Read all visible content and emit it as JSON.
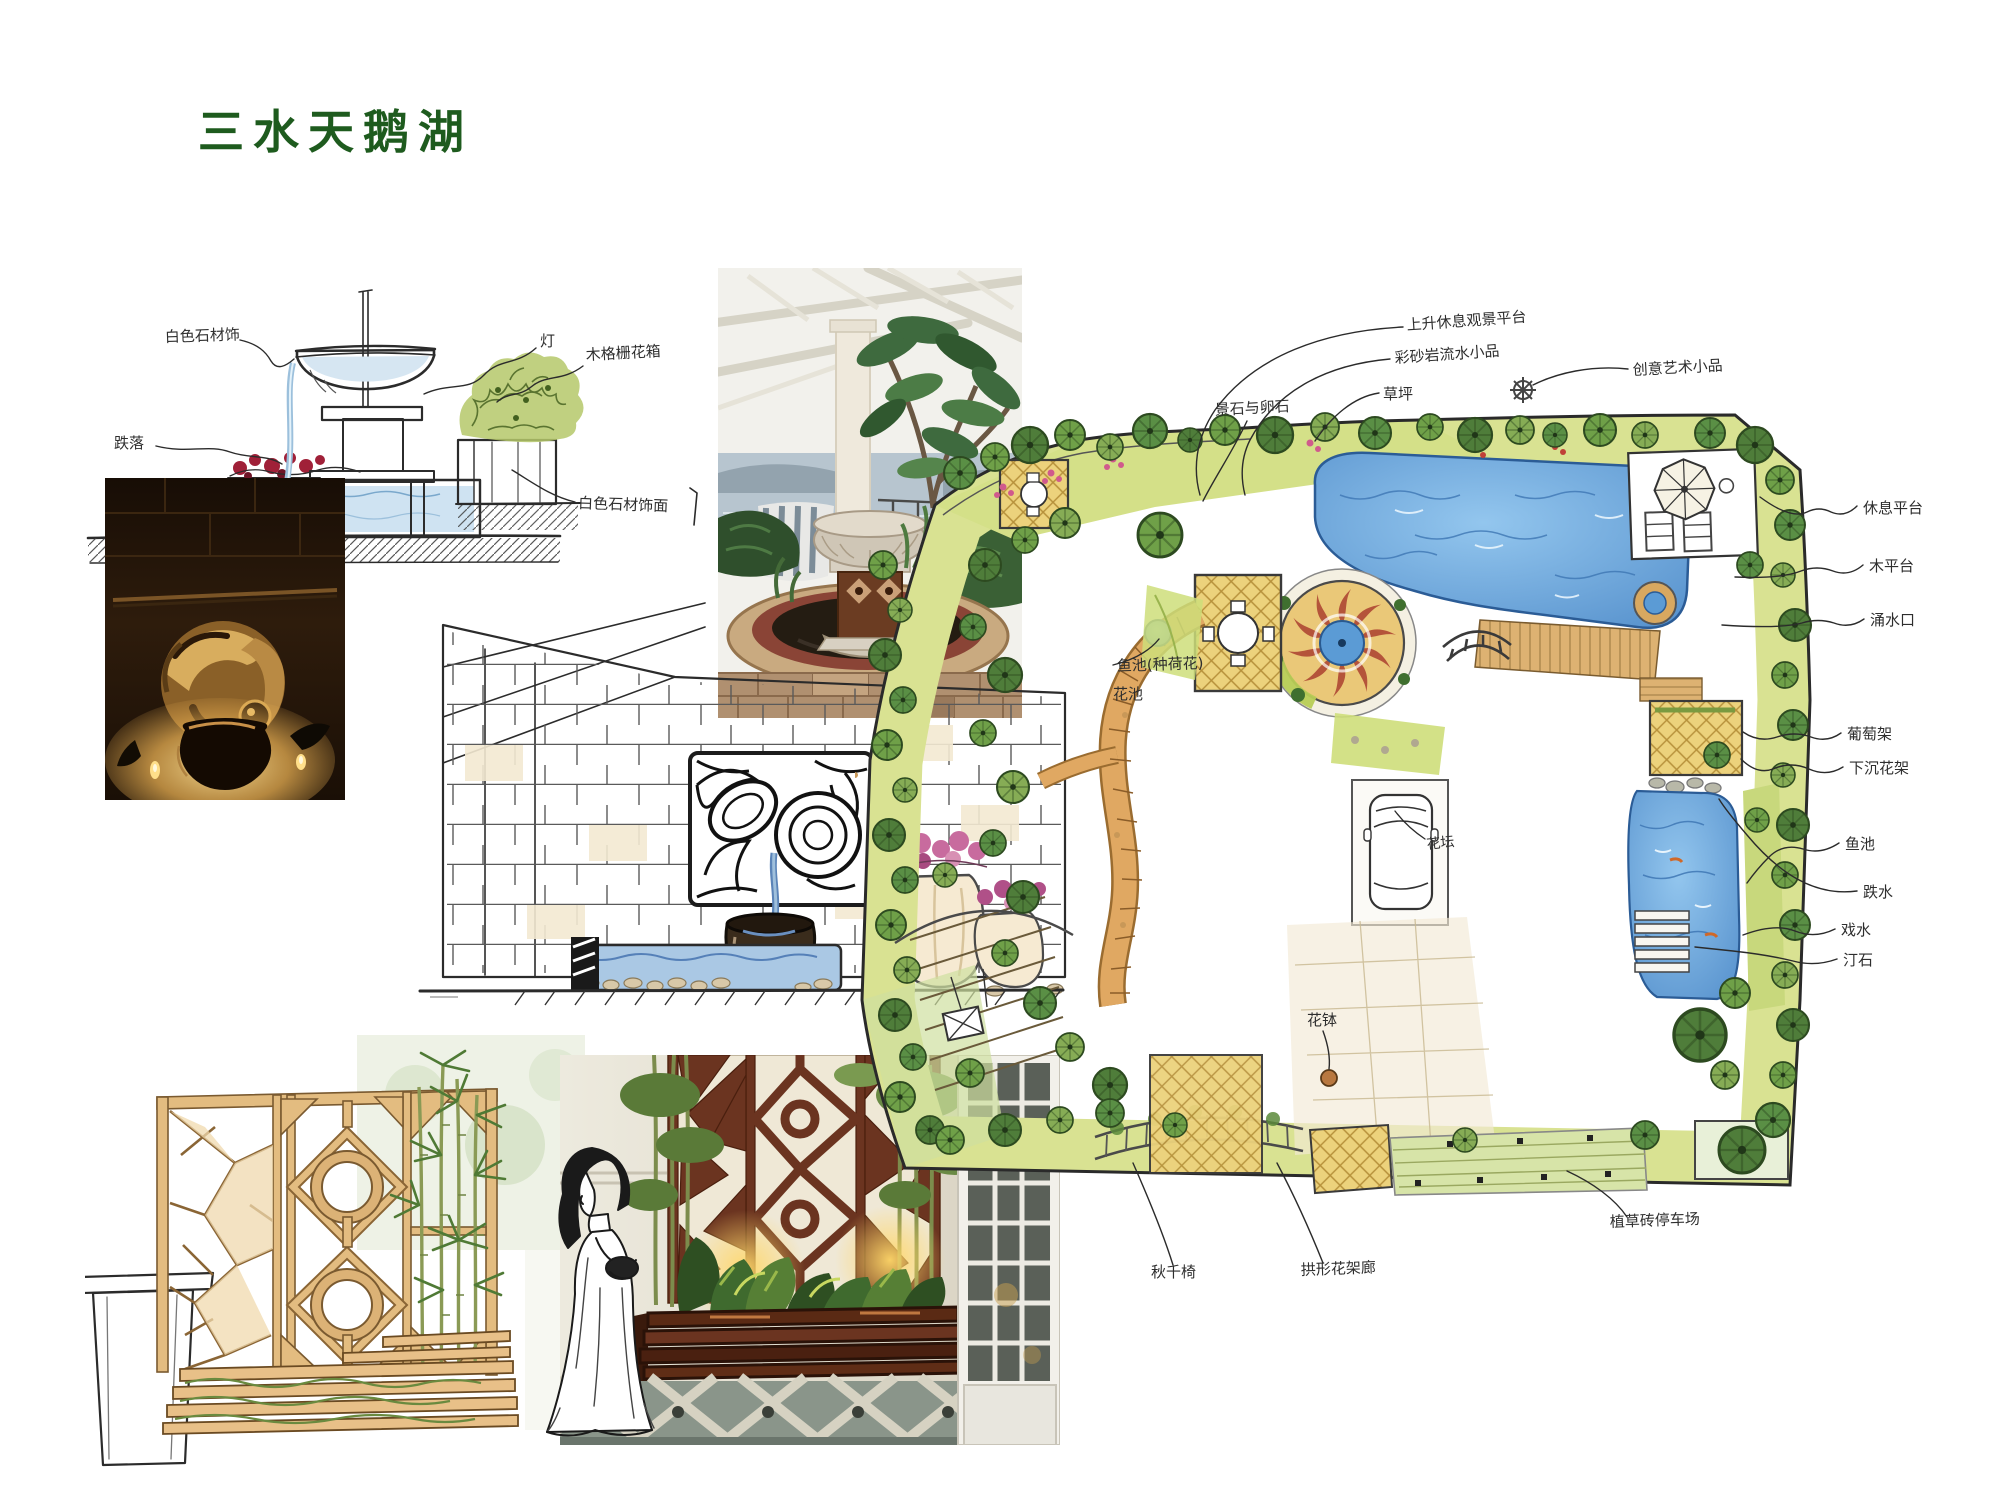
{
  "slide": {
    "title": "三水天鹅湖"
  },
  "colors": {
    "title_green": "#1e5b1e",
    "pool_blue": "#5b9bd5",
    "lattice_yellow": "#ecd27c",
    "sun_red": "#b4543a"
  },
  "fountain_sketch": {
    "labels": {
      "stone_trim": "白色石材饰",
      "lamp": "灯",
      "wood_planter": "木格栅花箱",
      "cascade": "跌落",
      "stone_facing": "白色石材饰面"
    }
  },
  "plan": {
    "labels": {
      "platform_top": "上升休息观景平台",
      "water_feature_top": "彩砂岩流水小品",
      "lawn": "草坪",
      "rocks": "景石与卵石",
      "art_piece": "创意艺术小品",
      "rest_platform": "休息平台",
      "wood_deck": "木平台",
      "spring": "涌水口",
      "grape_trellis": "葡萄架",
      "sunken_trellis": "下沉花架",
      "fish_pond": "鱼池",
      "cascade": "跌水",
      "play_water": "戏水",
      "stepping_stones": "汀石",
      "lotus_pond": "鱼池(种荷花)",
      "flower_bed": "花池",
      "parterre": "花坛",
      "flower_pot": "花钵",
      "swing_chair": "秋千椅",
      "arch_corridor": "拱形花架廊",
      "grass_paver_parking": "植草砖停车场"
    }
  }
}
